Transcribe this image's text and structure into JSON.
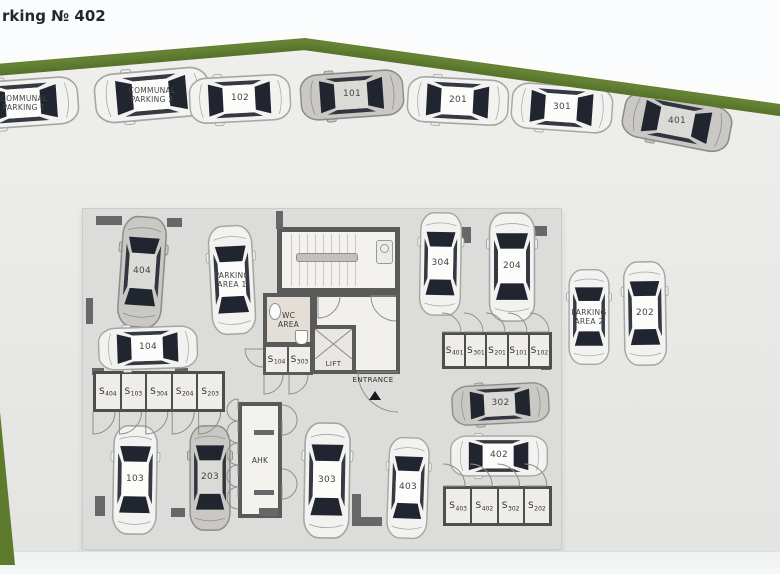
{
  "page": {
    "title": "rking № 402"
  },
  "colors": {
    "grass": "#5d7a2d",
    "ground": "#e9e9e7",
    "plan_floor": "#dcdcda",
    "wall": "#67676a",
    "car_white_body": "#f2f2f1",
    "car_gray_body": "#c9c8c5",
    "car_glass": "#20252f",
    "label_text": "#454545"
  },
  "floorplan": {
    "rooms": {
      "wc_area": {
        "line1": "WC",
        "line2": "AREA"
      },
      "lift": "LIFT",
      "entrance": "ENTRANCE",
      "ahk": "AHK"
    },
    "core_cells": [
      {
        "s": "S",
        "num": "104"
      },
      {
        "s": "S",
        "num": "303"
      }
    ],
    "storage_rows": [
      {
        "id": "row-left",
        "x": 93,
        "y": 371,
        "w": 132,
        "h": 41,
        "door": "bottom",
        "cells": [
          "404",
          "103",
          "304",
          "204",
          "203"
        ]
      },
      {
        "id": "row-mid-right",
        "x": 442,
        "y": 332,
        "w": 110,
        "h": 37,
        "door": "top",
        "cells": [
          "401",
          "301",
          "201",
          "101",
          "102"
        ]
      },
      {
        "id": "row-bottom-right",
        "x": 443,
        "y": 486,
        "w": 109,
        "h": 40,
        "door": "top",
        "cells": [
          "403",
          "402",
          "302",
          "202"
        ]
      }
    ],
    "cars": [
      {
        "id": "communal-parking-1",
        "label_lines": [
          "COMMUNAL",
          "PARKING 1"
        ],
        "x": 24,
        "y": 103,
        "rot": -94,
        "len": 112,
        "wid": 54,
        "color": "white"
      },
      {
        "id": "communal-parking-2",
        "label_lines": [
          "COMMUNAL",
          "PARKING 2"
        ],
        "x": 152,
        "y": 95,
        "rot": -95,
        "len": 118,
        "wid": 56,
        "color": "white"
      },
      {
        "id": "102",
        "label_lines": [
          "102"
        ],
        "x": 240,
        "y": 99,
        "rot": -93,
        "len": 104,
        "wid": 52,
        "color": "white"
      },
      {
        "id": "101",
        "label_lines": [
          "101"
        ],
        "x": 352,
        "y": 95,
        "rot": -94,
        "len": 106,
        "wid": 52,
        "color": "gray"
      },
      {
        "id": "201",
        "label_lines": [
          "201"
        ],
        "x": 458,
        "y": 101,
        "rot": -87,
        "len": 104,
        "wid": 52,
        "color": "white"
      },
      {
        "id": "301",
        "label_lines": [
          "301"
        ],
        "x": 562,
        "y": 108,
        "rot": -86,
        "len": 104,
        "wid": 52,
        "color": "white"
      },
      {
        "id": "401",
        "label_lines": [
          "401"
        ],
        "x": 677,
        "y": 122,
        "rot": -79,
        "len": 112,
        "wid": 52,
        "color": "gray"
      },
      {
        "id": "404",
        "label_lines": [
          "404"
        ],
        "x": 142,
        "y": 272,
        "rot": 4,
        "len": 114,
        "wid": 50,
        "color": "gray"
      },
      {
        "id": "parking-area-1",
        "label_lines": [
          "PARKING",
          "AREA 1"
        ],
        "x": 232,
        "y": 280,
        "rot": -3,
        "len": 112,
        "wid": 50,
        "color": "white"
      },
      {
        "id": "304",
        "label_lines": [
          "304"
        ],
        "x": 440,
        "y": 264,
        "rot": 1,
        "len": 106,
        "wid": 47,
        "color": "white"
      },
      {
        "id": "204",
        "label_lines": [
          "204"
        ],
        "x": 512,
        "y": 267,
        "rot": 0,
        "len": 112,
        "wid": 52,
        "color": "white"
      },
      {
        "id": "104",
        "label_lines": [
          "104"
        ],
        "x": 148,
        "y": 348,
        "rot": -92,
        "len": 102,
        "wid": 48,
        "color": "white"
      },
      {
        "id": "103",
        "label_lines": [
          "103"
        ],
        "x": 135,
        "y": 480,
        "rot": 1,
        "len": 112,
        "wid": 50,
        "color": "white"
      },
      {
        "id": "203",
        "label_lines": [
          "203"
        ],
        "x": 210,
        "y": 478,
        "rot": 0,
        "len": 108,
        "wid": 46,
        "color": "gray"
      },
      {
        "id": "303",
        "label_lines": [
          "303"
        ],
        "x": 327,
        "y": 480,
        "rot": 1,
        "len": 119,
        "wid": 52,
        "color": "white"
      },
      {
        "id": "403",
        "label_lines": [
          "403"
        ],
        "x": 408,
        "y": 488,
        "rot": 2,
        "len": 104,
        "wid": 46,
        "color": "white"
      },
      {
        "id": "302",
        "label_lines": [
          "302"
        ],
        "x": 500,
        "y": 404,
        "rot": -93,
        "len": 100,
        "wid": 45,
        "color": "gray"
      },
      {
        "id": "402",
        "label_lines": [
          "402"
        ],
        "x": 499,
        "y": 456,
        "rot": -90,
        "len": 100,
        "wid": 46,
        "color": "white"
      },
      {
        "id": "parking-area-2",
        "label_lines": [
          "PARKING",
          "AREA 2"
        ],
        "x": 589,
        "y": 317,
        "rot": 0,
        "len": 98,
        "wid": 46,
        "color": "white"
      },
      {
        "id": "202",
        "label_lines": [
          "202"
        ],
        "x": 645,
        "y": 313,
        "rot": -1,
        "len": 107,
        "wid": 48,
        "color": "white"
      }
    ]
  }
}
